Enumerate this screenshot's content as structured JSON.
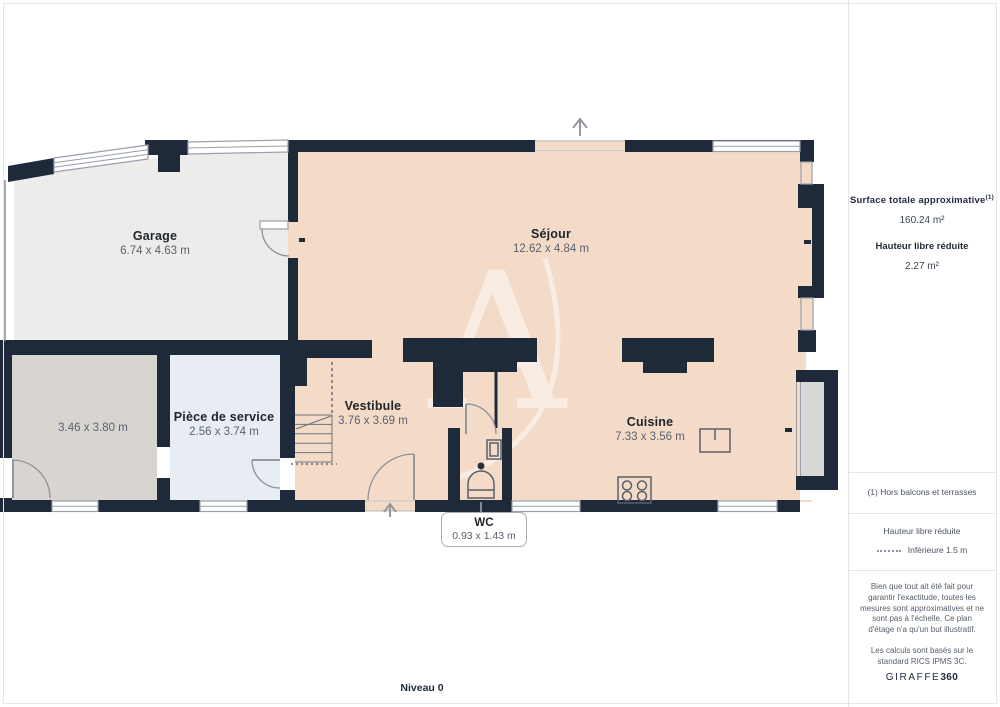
{
  "plan": {
    "level_label": "Niveau 0",
    "watermark_letter": "A",
    "rooms": [
      {
        "name": "Garage",
        "dims": "6.74 x 4.63 m"
      },
      {
        "name": "Séjour",
        "dims": "12.62 x 4.84 m"
      },
      {
        "name": "",
        "dims": "3.46 x 3.80 m"
      },
      {
        "name": "Pièce de service",
        "dims": "2.56 x 3.74 m"
      },
      {
        "name": "Vestibule",
        "dims": "3.76 x 3.69 m"
      },
      {
        "name": "Cuisine",
        "dims": "7.33 x 3.56 m"
      },
      {
        "name": "WC",
        "dims": "0.93 x 1.43 m"
      }
    ]
  },
  "sidebar": {
    "surface_title": "Surface totale approximative",
    "surface_footnote_marker": "(1)",
    "surface_value": "160.24 m²",
    "reduced_height_title": "Hauteur libre réduite",
    "reduced_height_value": "2.27 m²",
    "footnote": "(1) Hors balcons et terrasses",
    "legend_title": "Hauteur libre réduite",
    "legend_item": "Inférieure 1.5 m",
    "disclaimer_1": "Bien que tout ait été fait pour garantir l'exactitude, toutes les mesures sont approximatives et ne sont pas à l'échelle. Ce plan d'étage n'a qu'un but illustratif.",
    "disclaimer_2": "Les calculs sont basés sur le standard RICS IPMS 3C.",
    "brand_name": "GIRAFFE",
    "brand_suffix": "360"
  },
  "colors": {
    "wall": "#1e2a39",
    "floor_main": "#f4dbc8",
    "floor_garage": "#ececeb",
    "floor_room": "#d8d5d1",
    "floor_service": "#e8ecf3",
    "floor_wc": "#e2e7f0",
    "floor_bay": "#d7d7d6",
    "line": "#99a0a9",
    "navy": "#1f2b3a"
  }
}
